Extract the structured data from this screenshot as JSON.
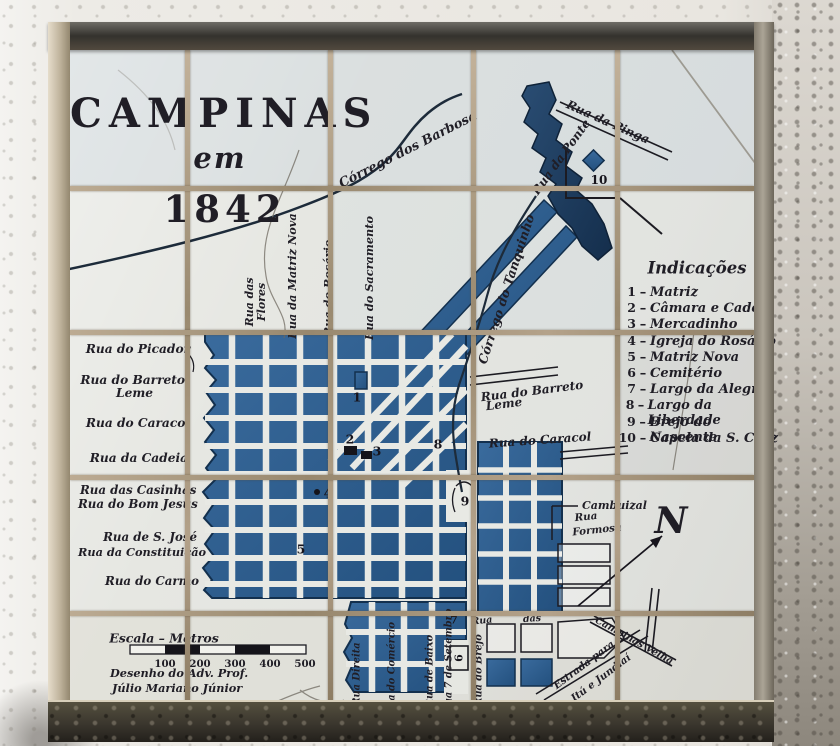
{
  "title": {
    "main": "CAMPINAS",
    "em": "em",
    "year": "1842"
  },
  "labels": {
    "corrego_barbosa": "Córrego dos Barbosa",
    "corrego_tanquinho": "Córrego do Tanquinho",
    "rua_da_ponte": "Rua da Ponte",
    "rua_da_pinga": "Rua da Pinga",
    "picador": "Rua do Picador",
    "barreto_leme_1": "Rua do Barreto",
    "barreto_leme_2": "Leme",
    "caracol": "Rua do Caracol",
    "cadeia": "Rua da Cadeia",
    "casinhas": "Rua das Casinhas",
    "bom_jesus": "Rua do Bom Jesus",
    "sao_jose": "Rua de S. José",
    "constituicao": "Rua da Constituição",
    "carmo": "Rua do Carmo",
    "flores_1": "Rua das",
    "flores_2": "Flores",
    "matriz_nova": "Rua da Matriz Nova",
    "rosario": "Rua do Rosário",
    "sacramento": "Rua do Sacramento",
    "barreto_r_1": "Rua do Barreto",
    "barreto_r_2": "Leme",
    "caracol_r": "Rua do Caracol",
    "cambuizal": "Cambuizal",
    "formosa_1": "Rua",
    "formosa_2": "Formosa",
    "rua_frag": "Rua",
    "das_frag": "das",
    "direita": "Rua Direita",
    "comercio": "Rua do Comércio",
    "baixo": "Rua de Baixo",
    "setembro": "Rua 7 de Setembro",
    "brejo": "Rua do Brejo",
    "campinas_velha": "Campinas Velha",
    "estrada_1": "Estrada para",
    "estrada_2": "Itú e Jundiaí"
  },
  "legend": {
    "title": "Indicações",
    "separator": "–",
    "items": [
      {
        "num": "1",
        "name": "Matriz"
      },
      {
        "num": "2",
        "name": "Câmara e Cadeia"
      },
      {
        "num": "3",
        "name": "Mercadinho"
      },
      {
        "num": "4",
        "name": "Igreja do Rosário"
      },
      {
        "num": "5",
        "name": "Matriz Nova"
      },
      {
        "num": "6",
        "name": "Cemitério"
      },
      {
        "num": "7",
        "name": "Largo da Alegria"
      },
      {
        "num": "8",
        "name": "Largo da Liberdade"
      },
      {
        "num": "9",
        "name": "Brejo do Nascente"
      },
      {
        "num": "10",
        "name": "Capela da S. Cruz"
      }
    ]
  },
  "markers": {
    "m1": "1",
    "m2": "2",
    "m3": "3",
    "m4": "4",
    "m5": "5",
    "m6": "6",
    "m7": "7",
    "m8": "8",
    "m9": "9",
    "m10": "10"
  },
  "compass": {
    "north": "N"
  },
  "scale": {
    "title": "Escala – Metros",
    "ticks": [
      "100",
      "200",
      "300",
      "400",
      "500"
    ],
    "credits": [
      "Desenho do Adv. Prof.",
      "Júlio Mariano Júnior"
    ]
  },
  "colors": {
    "map_blue": "#2e5f92",
    "map_navy": "#14304e",
    "ink": "#201e26",
    "tile": "#e6e7e2",
    "grout": "#a5947b"
  }
}
